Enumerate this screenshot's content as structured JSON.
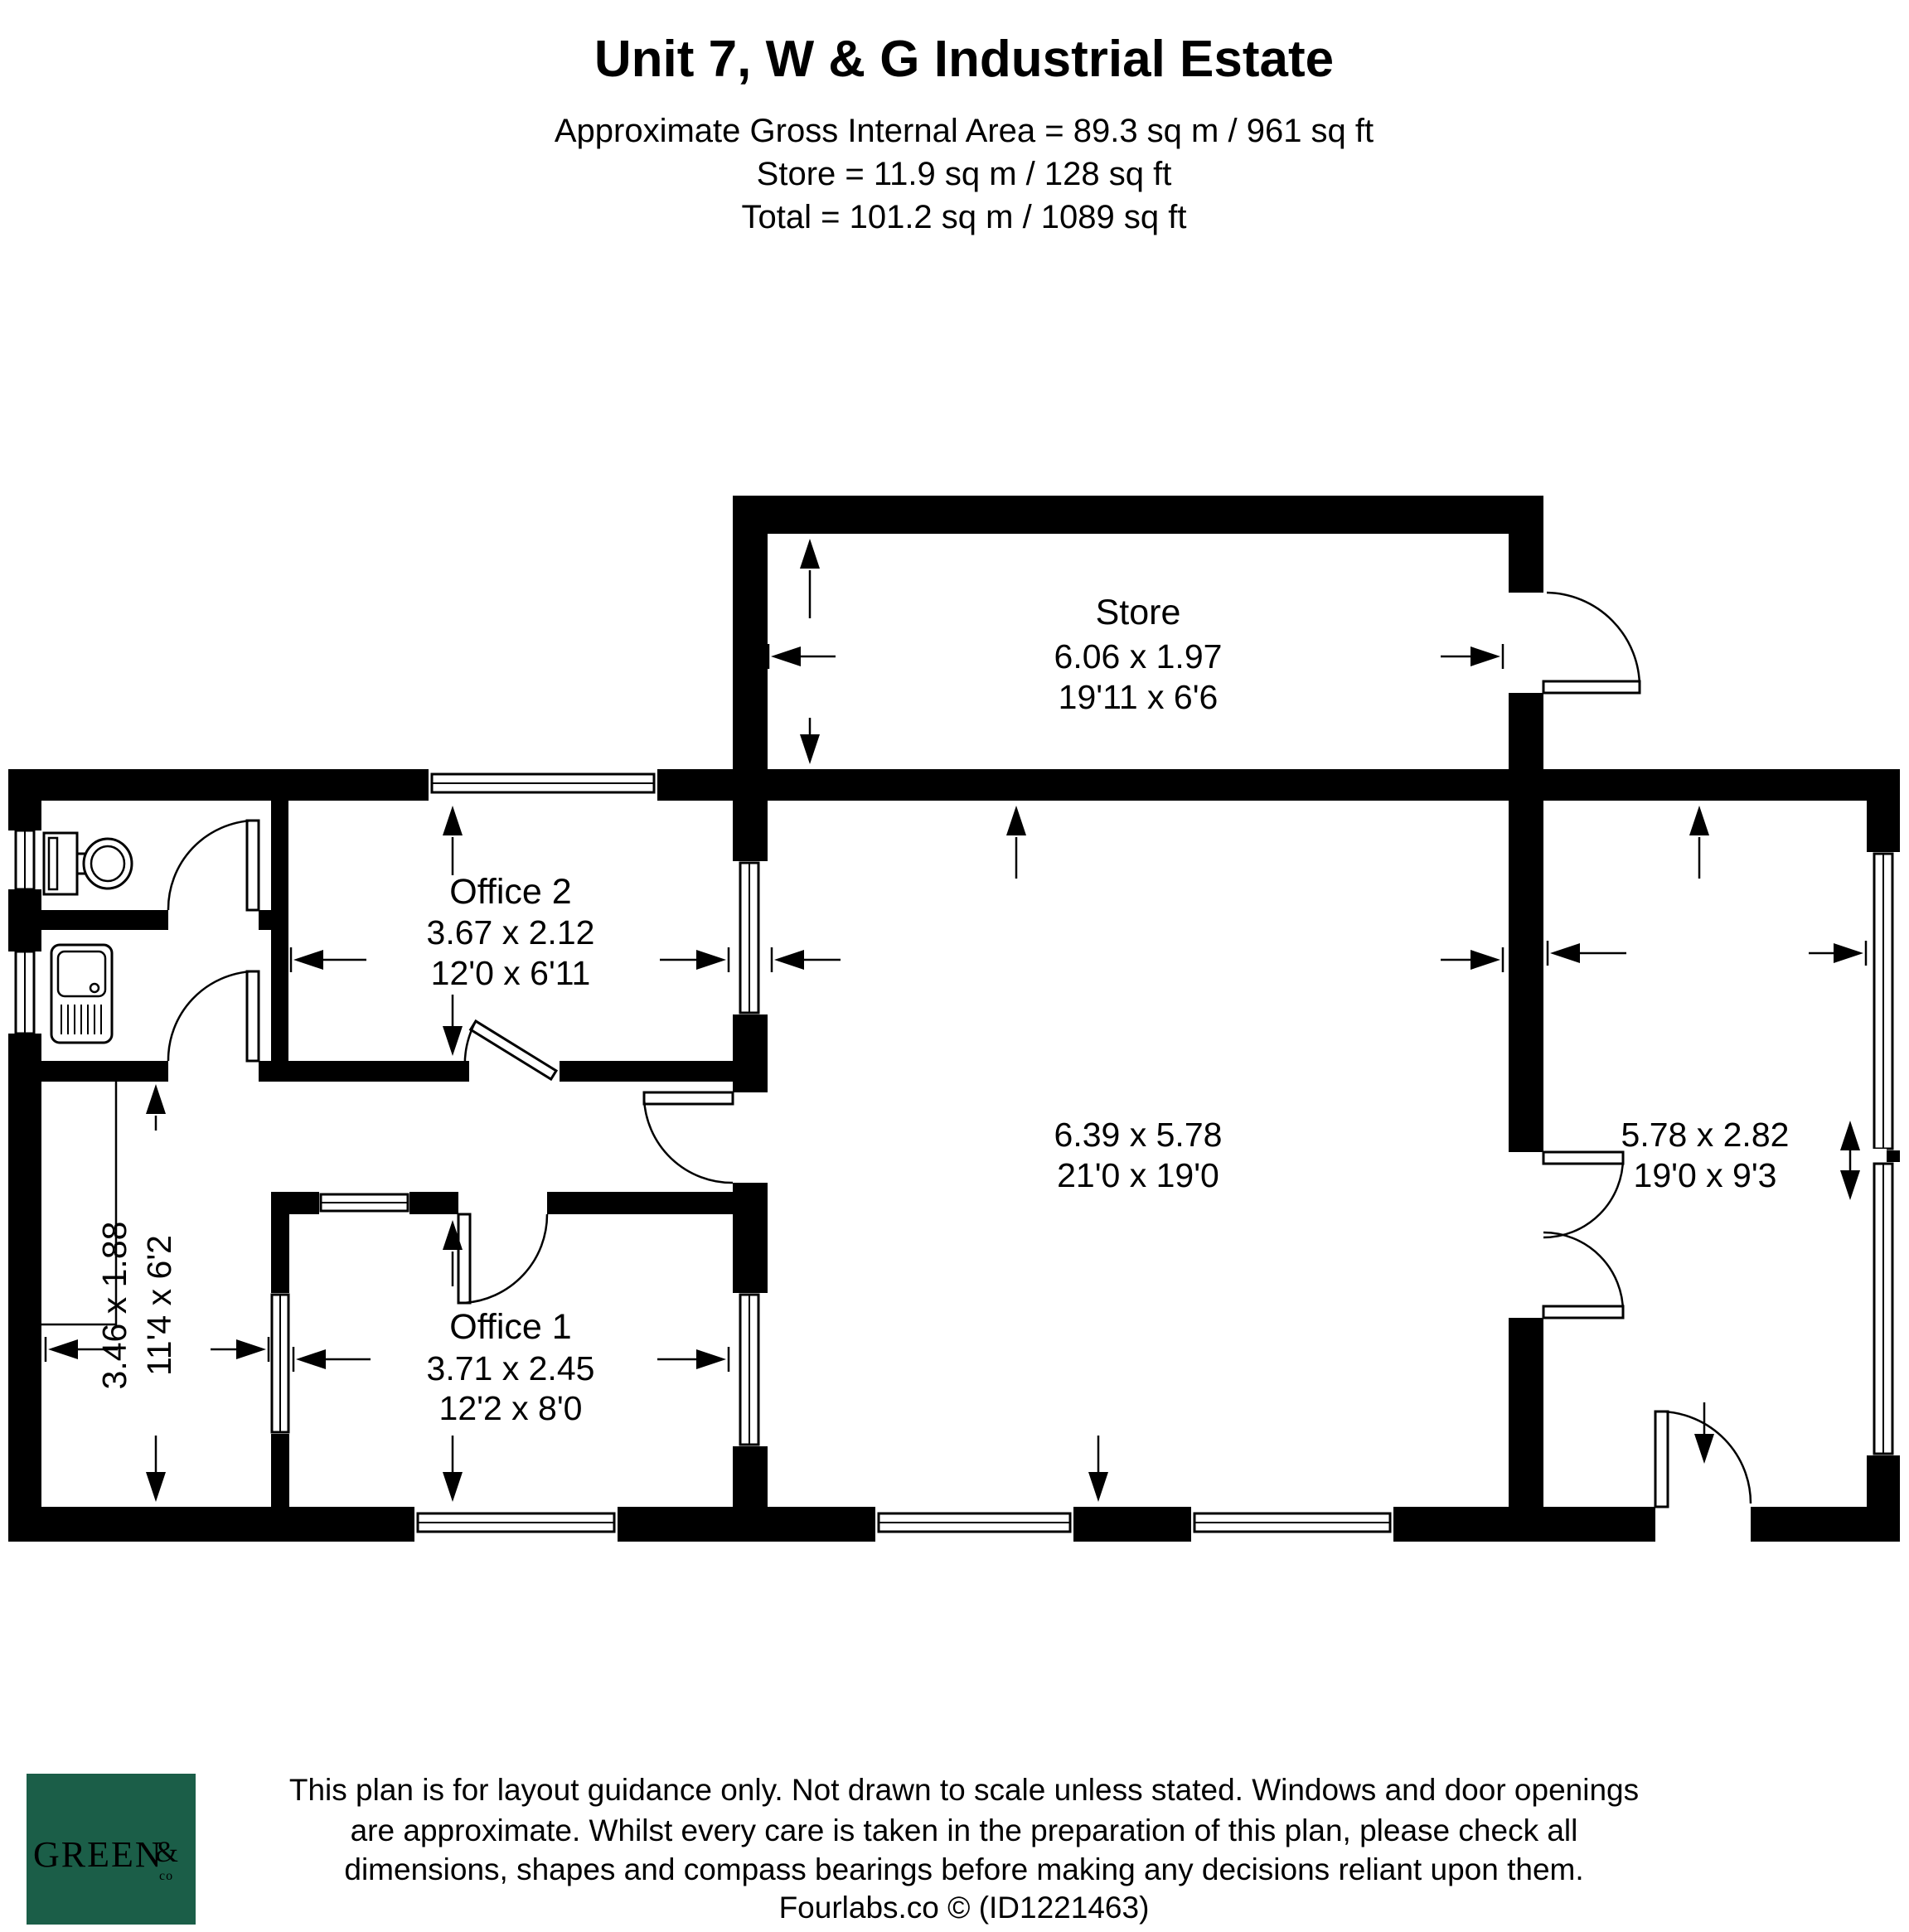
{
  "header": {
    "title": "Unit 7, W & G Industrial Estate",
    "area_line": "Approximate Gross Internal Area = 89.3 sq m / 961 sq ft",
    "store_line": "Store = 11.9 sq m / 128 sq ft",
    "total_line": "Total = 101.2 sq m / 1089 sq ft"
  },
  "rooms": {
    "store": {
      "name": "Store",
      "metric": "6.06 x 1.97",
      "imperial": "19'11 x 6'6"
    },
    "office2": {
      "name": "Office 2",
      "metric": "3.67 x 2.12",
      "imperial": "12'0 x 6'11"
    },
    "office1": {
      "name": "Office 1",
      "metric": "3.71 x 2.45",
      "imperial": "12'2 x 8'0"
    },
    "warehouse": {
      "metric": "6.39 x 5.78",
      "imperial": "21'0 x 19'0"
    },
    "right_room": {
      "metric": "5.78 x 2.82",
      "imperial": "19'0 x 9'3"
    },
    "left_room": {
      "metric": "3.46 x 1.88",
      "imperial": "11'4 x 6'2"
    }
  },
  "footer": {
    "logo": {
      "word": "GREEN",
      "amp": "&",
      "co": "co",
      "bg_color": "#1b5e48",
      "text_color": "#ffffff"
    },
    "disclaimer": [
      "This plan is for layout guidance only. Not drawn to scale unless stated. Windows and door openings",
      "are approximate. Whilst every care is taken in the preparation of this plan, please check all",
      "dimensions, shapes and compass bearings before making any decisions reliant upon them.",
      "Fourlabs.co © (ID1221463)"
    ]
  },
  "colors": {
    "wall": "#000000",
    "background": "#ffffff"
  }
}
